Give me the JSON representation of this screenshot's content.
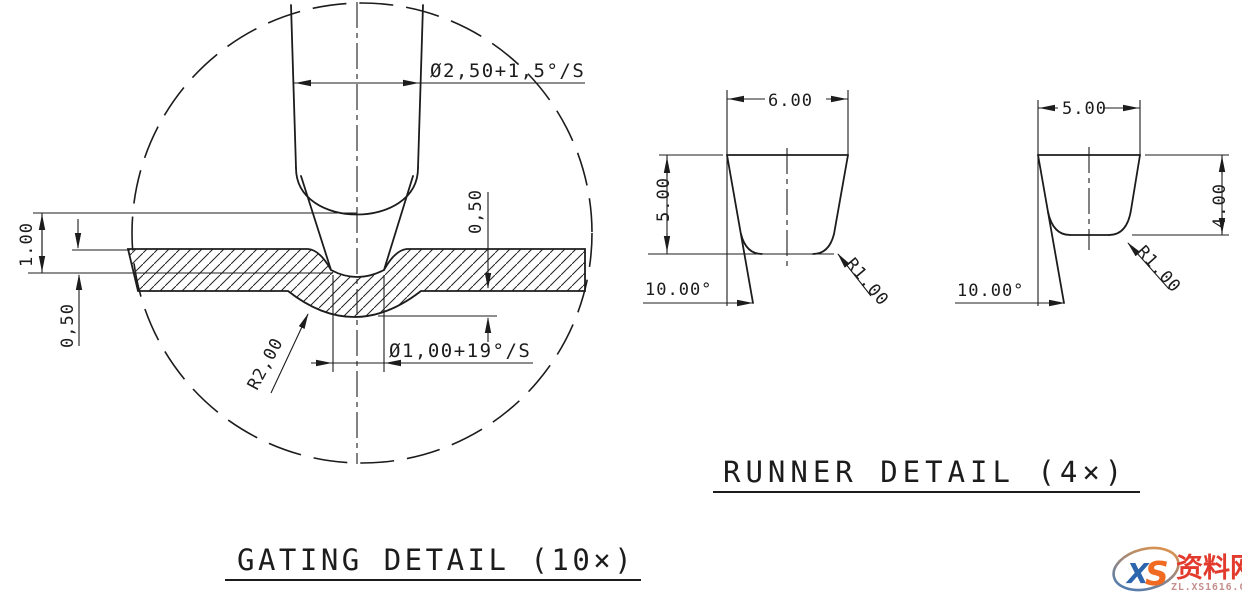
{
  "gating": {
    "title": "GATING DETAIL (10×)",
    "dim_top_diameter": "Ø2,50+1,5°/S",
    "dim_gate_diameter": "Ø1,00+19°/S",
    "dim_wall_thickness": "1.00",
    "dim_land_left": "0,50",
    "dim_depth_right": "0,50",
    "dim_radius": "R2,00"
  },
  "runner": {
    "title": "RUNNER DETAIL (4×)",
    "left": {
      "width": "6.00",
      "depth": "5.00",
      "draft_angle": "10.00°",
      "radius": "R1.00"
    },
    "right": {
      "width": "5.00",
      "depth": "4.00",
      "draft_angle": "10.00°",
      "radius": "R1.00"
    }
  },
  "watermark": {
    "logo_text_x": "X",
    "logo_text_s": "S",
    "site_name": "资料网",
    "site_url": "ZL.XS1616.COM"
  }
}
